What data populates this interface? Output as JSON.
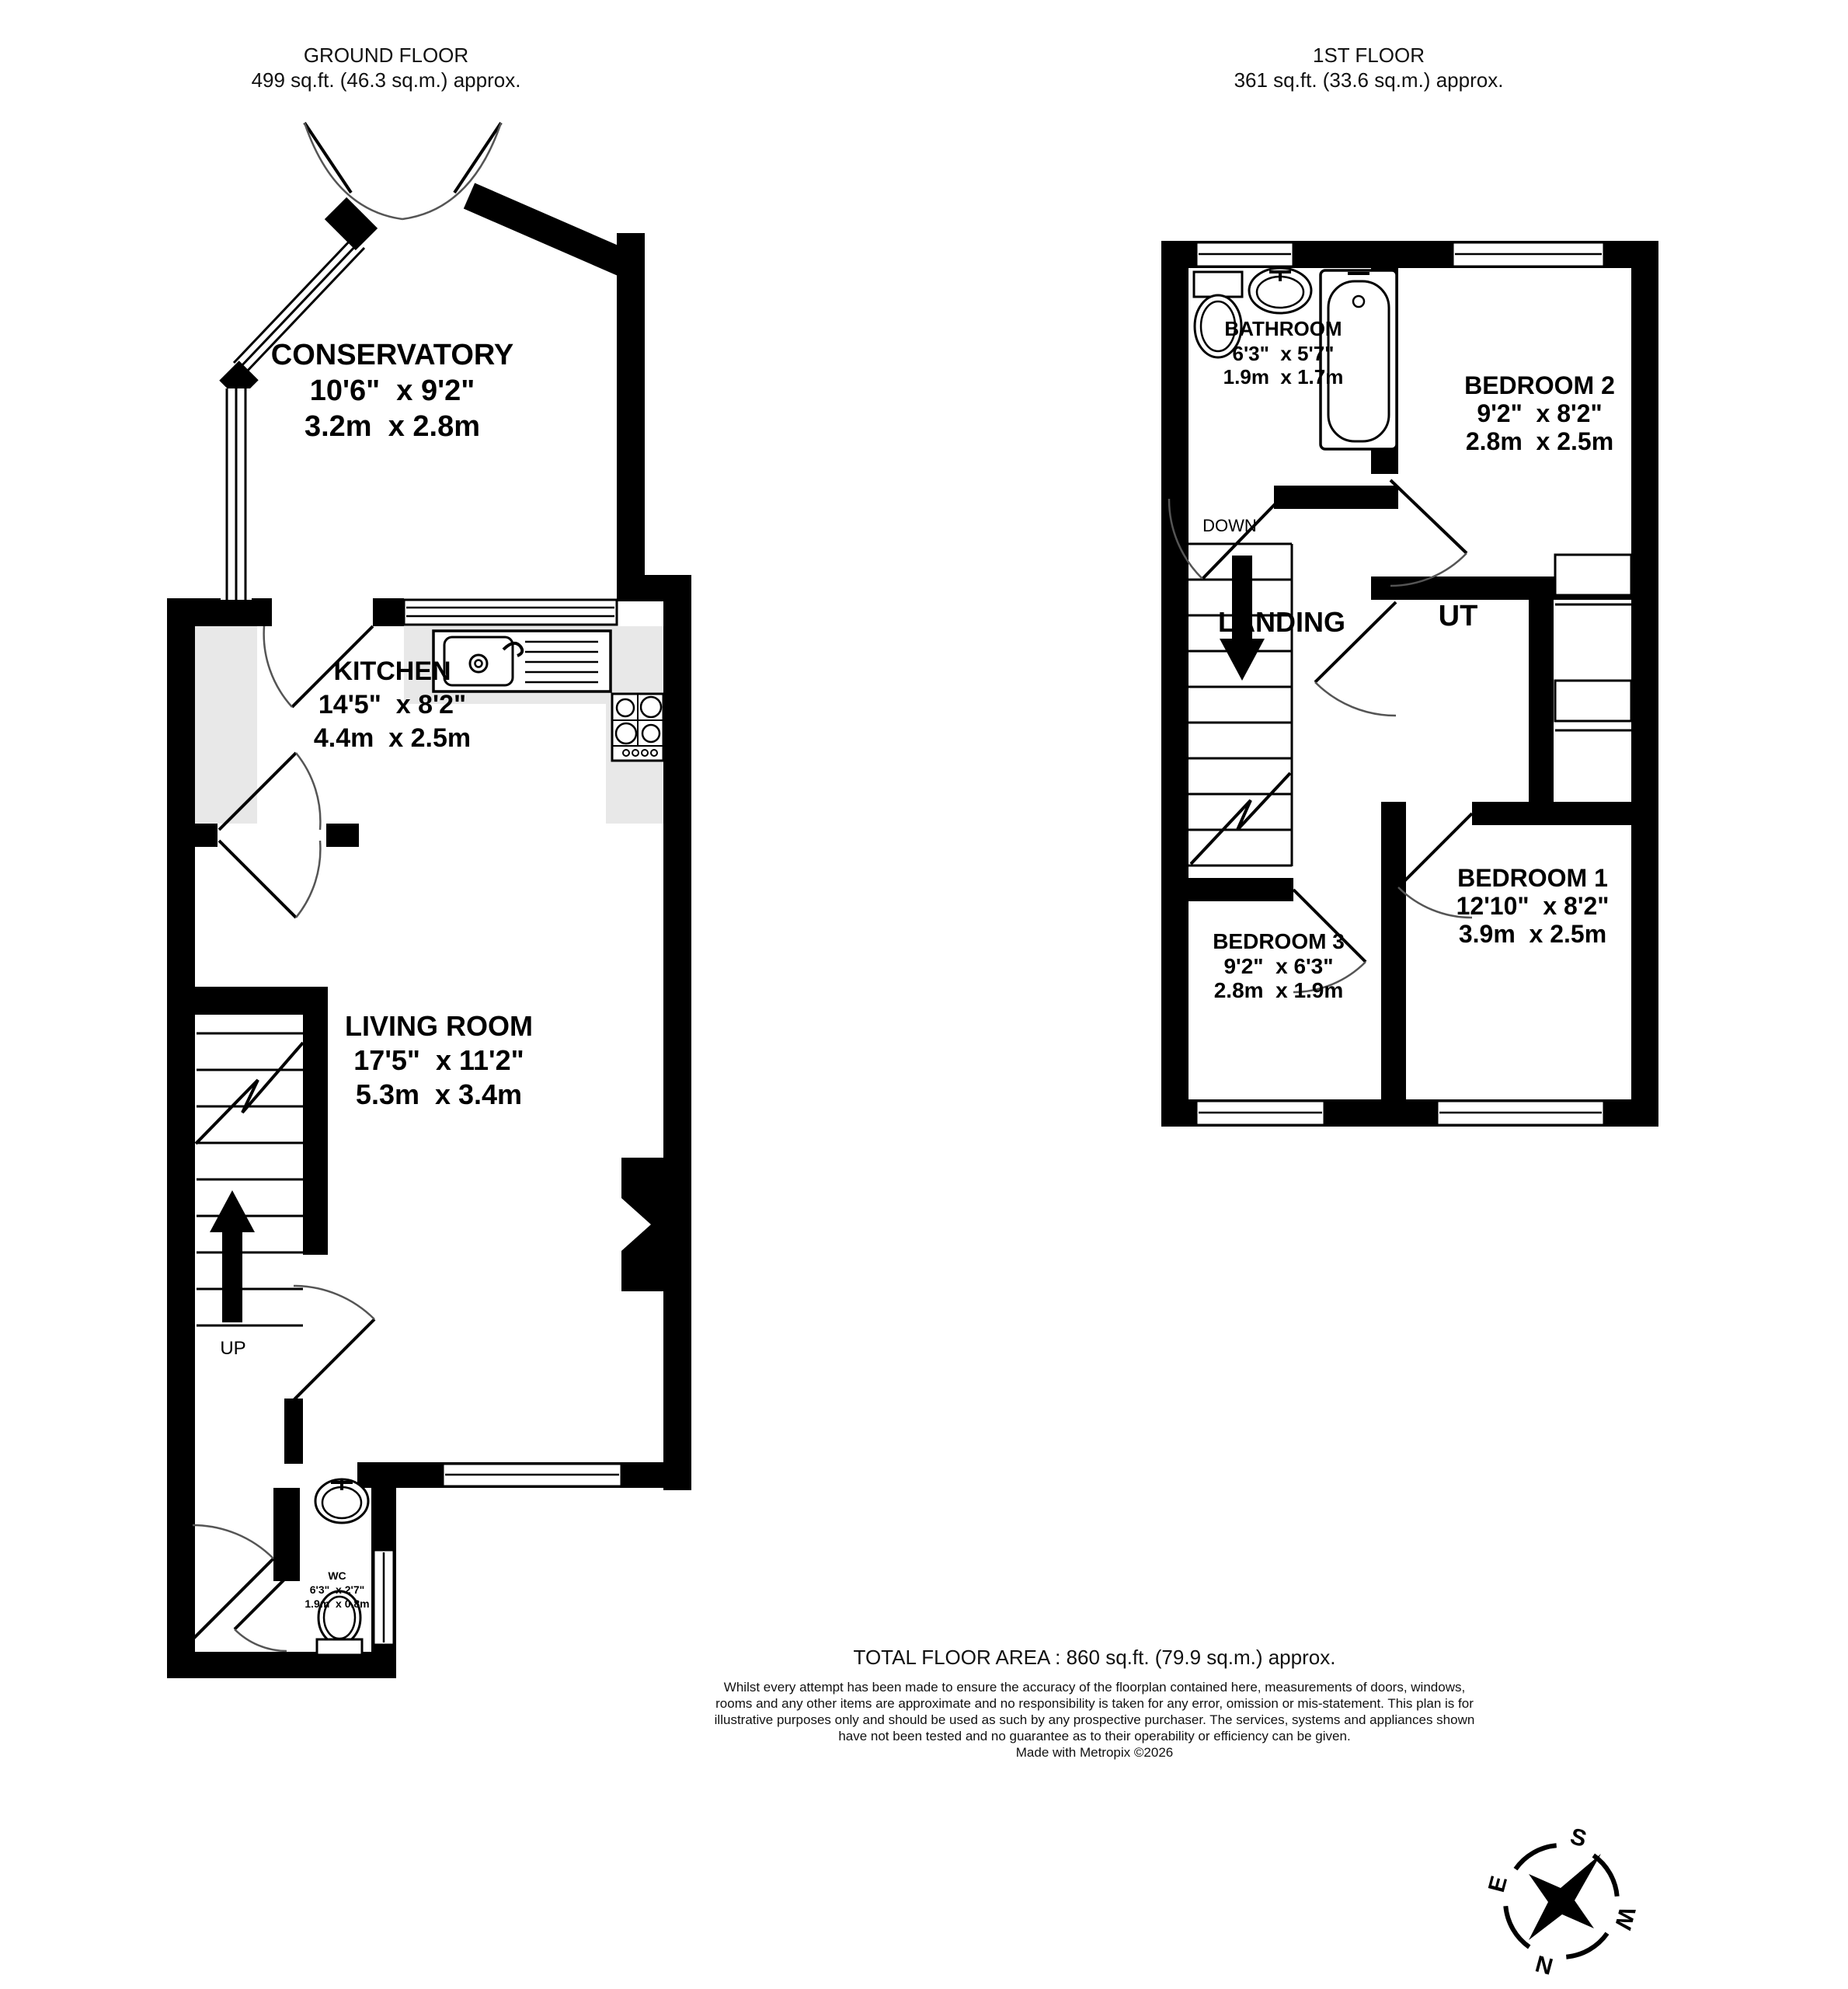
{
  "ground_floor": {
    "title": "GROUND FLOOR",
    "area": "499 sq.ft. (46.3 sq.m.) approx.",
    "conservatory": {
      "name": "CONSERVATORY",
      "imperial": "10'6\"  x 9'2\"",
      "metric": "3.2m  x 2.8m"
    },
    "kitchen": {
      "name": "KITCHEN",
      "imperial": "14'5\"  x 8'2\"",
      "metric": "4.4m  x 2.5m"
    },
    "living_room": {
      "name": "LIVING ROOM",
      "imperial": "17'5\"  x 11'2\"",
      "metric": "5.3m  x 3.4m"
    },
    "wc": {
      "name": "WC",
      "imperial": "6'3\"  x 2'7\"",
      "metric": "1.9m  x 0.8m"
    },
    "up_label": "UP"
  },
  "first_floor": {
    "title": "1ST FLOOR",
    "area": "361 sq.ft. (33.6 sq.m.) approx.",
    "bathroom": {
      "name": "BATHROOM",
      "imperial": "6'3\"  x 5'7\"",
      "metric": "1.9m  x 1.7m"
    },
    "bedroom2": {
      "name": "BEDROOM 2",
      "imperial": "9'2\"  x 8'2\"",
      "metric": "2.8m  x 2.5m"
    },
    "bedroom1": {
      "name": "BEDROOM 1",
      "imperial": "12'10\"  x 8'2\"",
      "metric": "3.9m  x 2.5m"
    },
    "bedroom3": {
      "name": "BEDROOM 3",
      "imperial": "9'2\"  x 6'3\"",
      "metric": "2.8m  x 1.9m"
    },
    "landing_label": "LANDING",
    "ut_label": "UT",
    "down_label": "DOWN"
  },
  "footer": {
    "total_area": "TOTAL FLOOR AREA : 860 sq.ft. (79.9 sq.m.) approx.",
    "disclaimer": "Whilst every attempt has been made to ensure the accuracy of the floorplan contained here, measurements of doors, windows, rooms and any other items are approximate and no responsibility is taken for any error, omission or mis-statement. This plan is for illustrative purposes only and should be used as such by any prospective purchaser. The services, systems and appliances shown have not been tested and no guarantee as to their operability or efficiency can be given.",
    "credit": "Made with Metropix ©2026"
  },
  "compass": {
    "n": "N",
    "e": "E",
    "s": "S",
    "w": "W"
  },
  "colors": {
    "wall": "#000000",
    "counter": "#e8e8e8",
    "background": "#ffffff"
  }
}
